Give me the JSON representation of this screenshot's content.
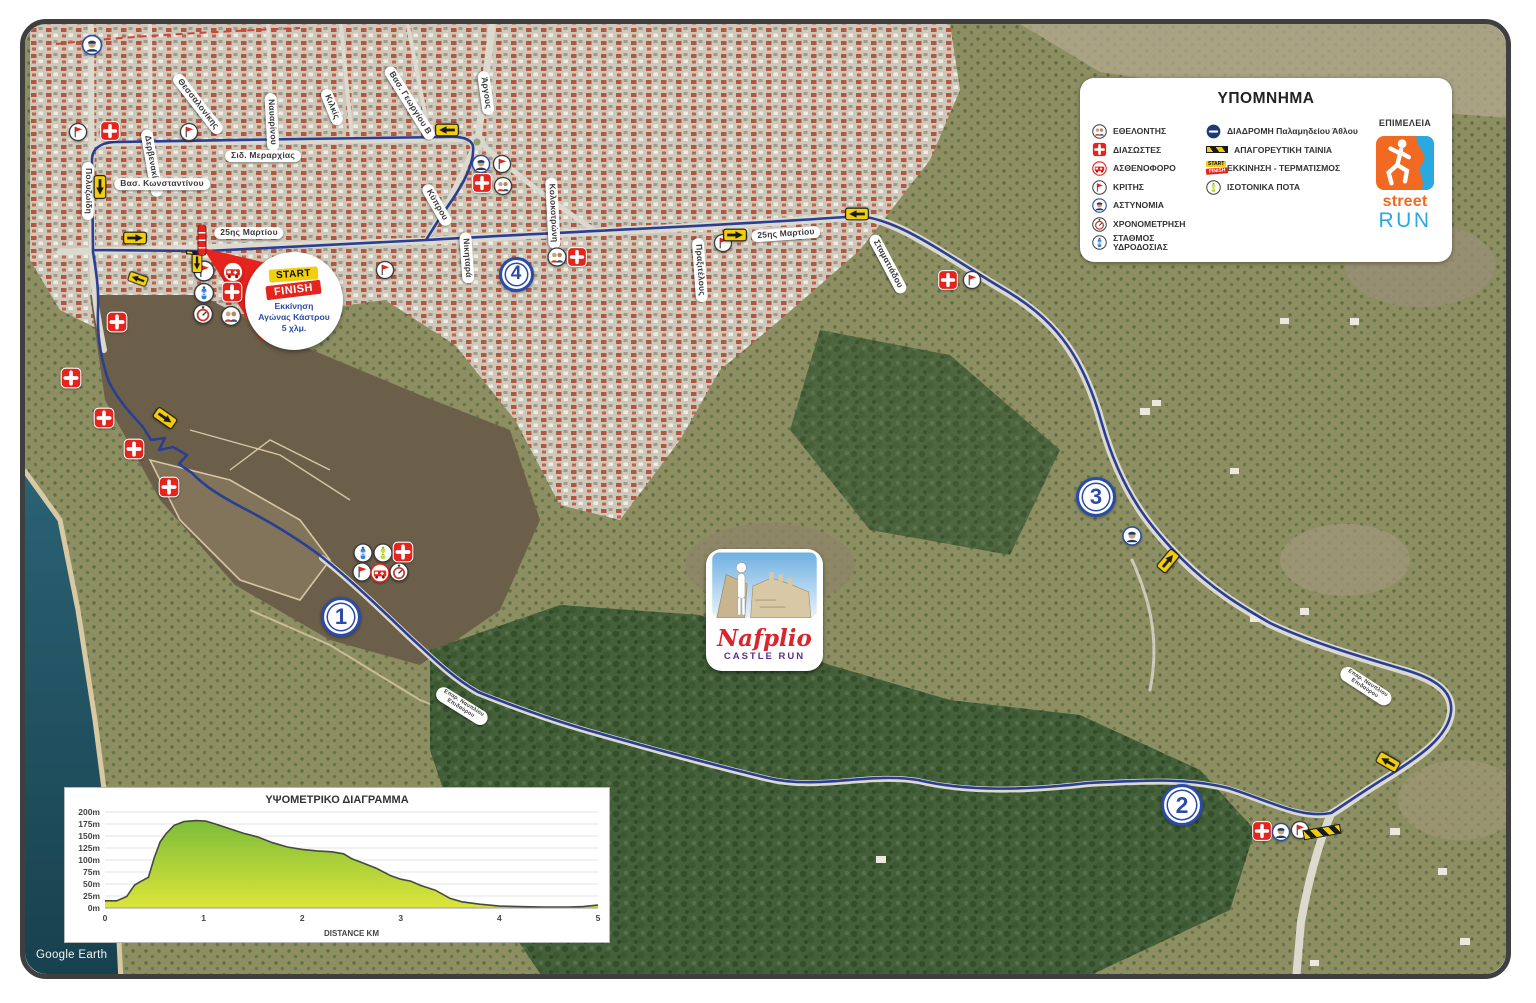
{
  "window": {
    "watermark": "Google Earth"
  },
  "legend": {
    "title": "ΥΠΟΜΝΗΜΑ",
    "col1": [
      {
        "icon": "volunteers",
        "label": "ΕΘΕΛΟΝΤΗΣ"
      },
      {
        "icon": "cross",
        "label": "ΔΙΑΣΩΣΤΕΣ"
      },
      {
        "icon": "ambulance",
        "label": "ΑΣΘΕΝΟΦΟΡΟ"
      },
      {
        "icon": "flag",
        "label": "ΚΡΙΤΗΣ"
      },
      {
        "icon": "police",
        "label": "ΑΣΤΥΝΟΜΙΑ"
      },
      {
        "icon": "timer",
        "label": "ΧΡΟΝΟΜΕΤΡΗΣΗ"
      },
      {
        "icon": "water",
        "label": "ΣΤΑΘΜΟΣ ΥΔΡΟΔΟΣΙΑΣ"
      }
    ],
    "col2": [
      {
        "icon": "route",
        "label": "ΔΙΑΔΡΟΜΗ Παλαμηδείου Άθλου"
      },
      {
        "icon": "tape",
        "label": "ΑΠΑΓΟΡΕΥΤΙΚΗ ΤΑΙΝΙΑ"
      },
      {
        "icon": "sf",
        "label": "ΕΚΚΙΝΗΣΗ - ΤΕΡΜΑΤΙΣΜΟΣ"
      },
      {
        "icon": "isotonic",
        "label": "ΙΣΟΤΟΝΙΚΑ ΠΟΤΑ"
      }
    ],
    "epimeleia_label": "ΕΠΙΜΕΛΕΙΑ",
    "logo_line1": "street",
    "logo_line2": "RUN"
  },
  "start_callout": {
    "start_label": "START",
    "finish_label": "FINISH",
    "text_lines": [
      "Εκκίνηση",
      "Αγώνας Κάστρου",
      "5 χλμ."
    ]
  },
  "event_logo": {
    "title": "Nafplio",
    "subtitle": "CASTLE RUN"
  },
  "km_markers": [
    {
      "n": "1",
      "x": 341,
      "y": 617,
      "d": 40
    },
    {
      "n": "2",
      "x": 1182,
      "y": 805,
      "d": 42
    },
    {
      "n": "3",
      "x": 1096,
      "y": 497,
      "d": 40
    },
    {
      "n": "4",
      "x": 516,
      "y": 274,
      "d": 35
    }
  ],
  "street_labels": [
    {
      "text": "Πολυζωίδη",
      "x": 88,
      "y": 191,
      "r": 90
    },
    {
      "text": "Δερβενακίων",
      "x": 152,
      "y": 163,
      "r": 80
    },
    {
      "text": "Θεσσαλονίκης",
      "x": 198,
      "y": 104,
      "r": 52
    },
    {
      "text": "Ναυαρίνου",
      "x": 272,
      "y": 122,
      "r": 87
    },
    {
      "text": "Κιλκίς",
      "x": 332,
      "y": 107,
      "r": 68
    },
    {
      "text": "Βασ. Γεωργίου Β",
      "x": 410,
      "y": 103,
      "r": 58
    },
    {
      "text": "Άργους",
      "x": 486,
      "y": 93,
      "r": 82
    },
    {
      "text": "Σιδ. Μεραρχίας",
      "x": 263,
      "y": 156,
      "r": 0
    },
    {
      "text": "Βασ. Κωνσταντίνου",
      "x": 162,
      "y": 184,
      "r": 0
    },
    {
      "text": "25ης Μαρτίου",
      "x": 249,
      "y": 233,
      "r": 0
    },
    {
      "text": "Κύπρου",
      "x": 437,
      "y": 205,
      "r": 60
    },
    {
      "text": "Νικηταρά",
      "x": 467,
      "y": 258,
      "r": 86
    },
    {
      "text": "Κολοκοτρώνη",
      "x": 553,
      "y": 213,
      "r": 87
    },
    {
      "text": "25ης Μαρτίου",
      "x": 786,
      "y": 234,
      "r": -4
    },
    {
      "text": "Πραξιτέλους",
      "x": 700,
      "y": 270,
      "r": 86
    },
    {
      "text": "Σταματιάδου",
      "x": 888,
      "y": 264,
      "r": 62
    },
    {
      "text": "Επαρ. Ναυπλίου\nΕπιδαύρου",
      "x": 462,
      "y": 706,
      "r": 32,
      "fs": 5.5
    },
    {
      "text": "Επαρ. Ναυπλίου\nΕπιδαύρου",
      "x": 1366,
      "y": 686,
      "r": 33,
      "fs": 5.5
    }
  ],
  "map_markers": [
    {
      "t": "police",
      "x": 92,
      "y": 45,
      "s": 21
    },
    {
      "t": "cross",
      "x": 110,
      "y": 131,
      "s": 20
    },
    {
      "t": "flag",
      "x": 78,
      "y": 132,
      "s": 19
    },
    {
      "t": "flag",
      "x": 189,
      "y": 132,
      "s": 19
    },
    {
      "t": "flag",
      "x": 385,
      "y": 270,
      "s": 19
    },
    {
      "t": "police",
      "x": 481,
      "y": 164,
      "s": 19
    },
    {
      "t": "flag",
      "x": 502,
      "y": 164,
      "s": 19
    },
    {
      "t": "cross",
      "x": 482,
      "y": 183,
      "s": 20
    },
    {
      "t": "volunteers",
      "x": 503,
      "y": 186,
      "s": 19
    },
    {
      "t": "volunteers",
      "x": 557,
      "y": 257,
      "s": 20
    },
    {
      "t": "cross",
      "x": 577,
      "y": 257,
      "s": 20
    },
    {
      "t": "flag",
      "x": 723,
      "y": 243,
      "s": 19
    },
    {
      "t": "cross",
      "x": 948,
      "y": 280,
      "s": 20
    },
    {
      "t": "flag",
      "x": 972,
      "y": 280,
      "s": 19
    },
    {
      "t": "police",
      "x": 1132,
      "y": 536,
      "s": 20
    },
    {
      "t": "cross",
      "x": 1262,
      "y": 831,
      "s": 20
    },
    {
      "t": "police",
      "x": 1281,
      "y": 832,
      "s": 19
    },
    {
      "t": "flag",
      "x": 1300,
      "y": 830,
      "s": 19
    },
    {
      "t": "flag",
      "x": 204,
      "y": 271,
      "s": 22
    },
    {
      "t": "ambulance",
      "x": 233,
      "y": 272,
      "s": 22
    },
    {
      "t": "water",
      "x": 204,
      "y": 293,
      "s": 21
    },
    {
      "t": "cross",
      "x": 232,
      "y": 292,
      "s": 21
    },
    {
      "t": "timer",
      "x": 203,
      "y": 314,
      "s": 21
    },
    {
      "t": "volunteers",
      "x": 231,
      "y": 316,
      "s": 21
    },
    {
      "t": "water",
      "x": 363,
      "y": 553,
      "s": 20
    },
    {
      "t": "isotonic",
      "x": 383,
      "y": 553,
      "s": 20
    },
    {
      "t": "cross",
      "x": 403,
      "y": 552,
      "s": 21
    },
    {
      "t": "flag",
      "x": 362,
      "y": 572,
      "s": 20
    },
    {
      "t": "ambulance",
      "x": 380,
      "y": 573,
      "s": 20
    },
    {
      "t": "timer",
      "x": 399,
      "y": 572,
      "s": 20
    },
    {
      "t": "cross",
      "x": 117,
      "y": 322,
      "s": 21
    },
    {
      "t": "cross",
      "x": 71,
      "y": 378,
      "s": 21
    },
    {
      "t": "cross",
      "x": 104,
      "y": 418,
      "s": 21
    },
    {
      "t": "cross",
      "x": 134,
      "y": 449,
      "s": 21
    },
    {
      "t": "cross",
      "x": 169,
      "y": 487,
      "s": 21
    },
    {
      "t": "arrow",
      "x": 100,
      "y": 187,
      "s": 24,
      "r": 90
    },
    {
      "t": "arrow",
      "x": 135,
      "y": 238,
      "s": 24,
      "r": 0
    },
    {
      "t": "arrow",
      "x": 447,
      "y": 130,
      "s": 24,
      "r": 180
    },
    {
      "t": "arrow",
      "x": 735,
      "y": 235,
      "s": 24,
      "r": 0
    },
    {
      "t": "arrow",
      "x": 857,
      "y": 214,
      "s": 24,
      "r": 180
    },
    {
      "t": "arrow",
      "x": 1168,
      "y": 561,
      "s": 24,
      "r": -50
    },
    {
      "t": "arrow",
      "x": 1388,
      "y": 762,
      "s": 24,
      "r": 210
    },
    {
      "t": "arrow",
      "x": 165,
      "y": 418,
      "s": 24,
      "r": 35
    },
    {
      "t": "arrow",
      "x": 197,
      "y": 263,
      "s": 20,
      "r": 90
    },
    {
      "t": "arrow",
      "x": 138,
      "y": 279,
      "s": 20,
      "r": 200
    },
    {
      "t": "tape",
      "x": 1322,
      "y": 832,
      "s": 38,
      "r": -10
    },
    {
      "t": "tape",
      "x": 194,
      "y": 253,
      "s": 16,
      "r": 5
    },
    {
      "t": "pole",
      "x": 202,
      "y": 240,
      "s": 9
    }
  ],
  "chart_data": {
    "type": "area",
    "title": "ΥΨΟΜΕΤΡΙΚΟ ΔΙΑΓΡΑΜΜΑ",
    "xlabel": "DISTANCE KM",
    "y_unit": "m",
    "x_ticks": [
      0,
      1,
      2,
      3,
      4,
      5
    ],
    "y_ticks": [
      0,
      25,
      50,
      75,
      100,
      125,
      150,
      175,
      200
    ],
    "xlim": [
      0,
      5
    ],
    "ylim": [
      0,
      200
    ],
    "grid": true,
    "points": [
      [
        0,
        15
      ],
      [
        0.12,
        15
      ],
      [
        0.22,
        24
      ],
      [
        0.3,
        48
      ],
      [
        0.36,
        55
      ],
      [
        0.44,
        64
      ],
      [
        0.5,
        105
      ],
      [
        0.56,
        138
      ],
      [
        0.62,
        155
      ],
      [
        0.7,
        172
      ],
      [
        0.8,
        180
      ],
      [
        0.92,
        182
      ],
      [
        1.02,
        181
      ],
      [
        1.12,
        175
      ],
      [
        1.25,
        166
      ],
      [
        1.4,
        156
      ],
      [
        1.55,
        148
      ],
      [
        1.7,
        136
      ],
      [
        1.85,
        127
      ],
      [
        2.0,
        122
      ],
      [
        2.15,
        119
      ],
      [
        2.3,
        117
      ],
      [
        2.42,
        113
      ],
      [
        2.5,
        103
      ],
      [
        2.6,
        95
      ],
      [
        2.75,
        83
      ],
      [
        2.9,
        67
      ],
      [
        3.0,
        60
      ],
      [
        3.1,
        56
      ],
      [
        3.2,
        47
      ],
      [
        3.35,
        37
      ],
      [
        3.5,
        20
      ],
      [
        3.62,
        13
      ],
      [
        3.8,
        8
      ],
      [
        4.0,
        4
      ],
      [
        4.2,
        3
      ],
      [
        4.45,
        2
      ],
      [
        4.7,
        2
      ],
      [
        4.85,
        3
      ],
      [
        5.0,
        6
      ]
    ]
  },
  "colors": {
    "route_blue": "#2a3e94",
    "marker_red": "#e5251d",
    "sign_yellow": "#f2ce0c",
    "ring_blue": "#2b4ba6",
    "logo_orange": "#f26a21",
    "logo_blue": "#2aa9e0",
    "nafplio_red": "#d8262c",
    "castle_purple": "#5b2d8e",
    "chart_fill_top": "#7cbd3a",
    "chart_fill_bottom": "#dde53a"
  }
}
